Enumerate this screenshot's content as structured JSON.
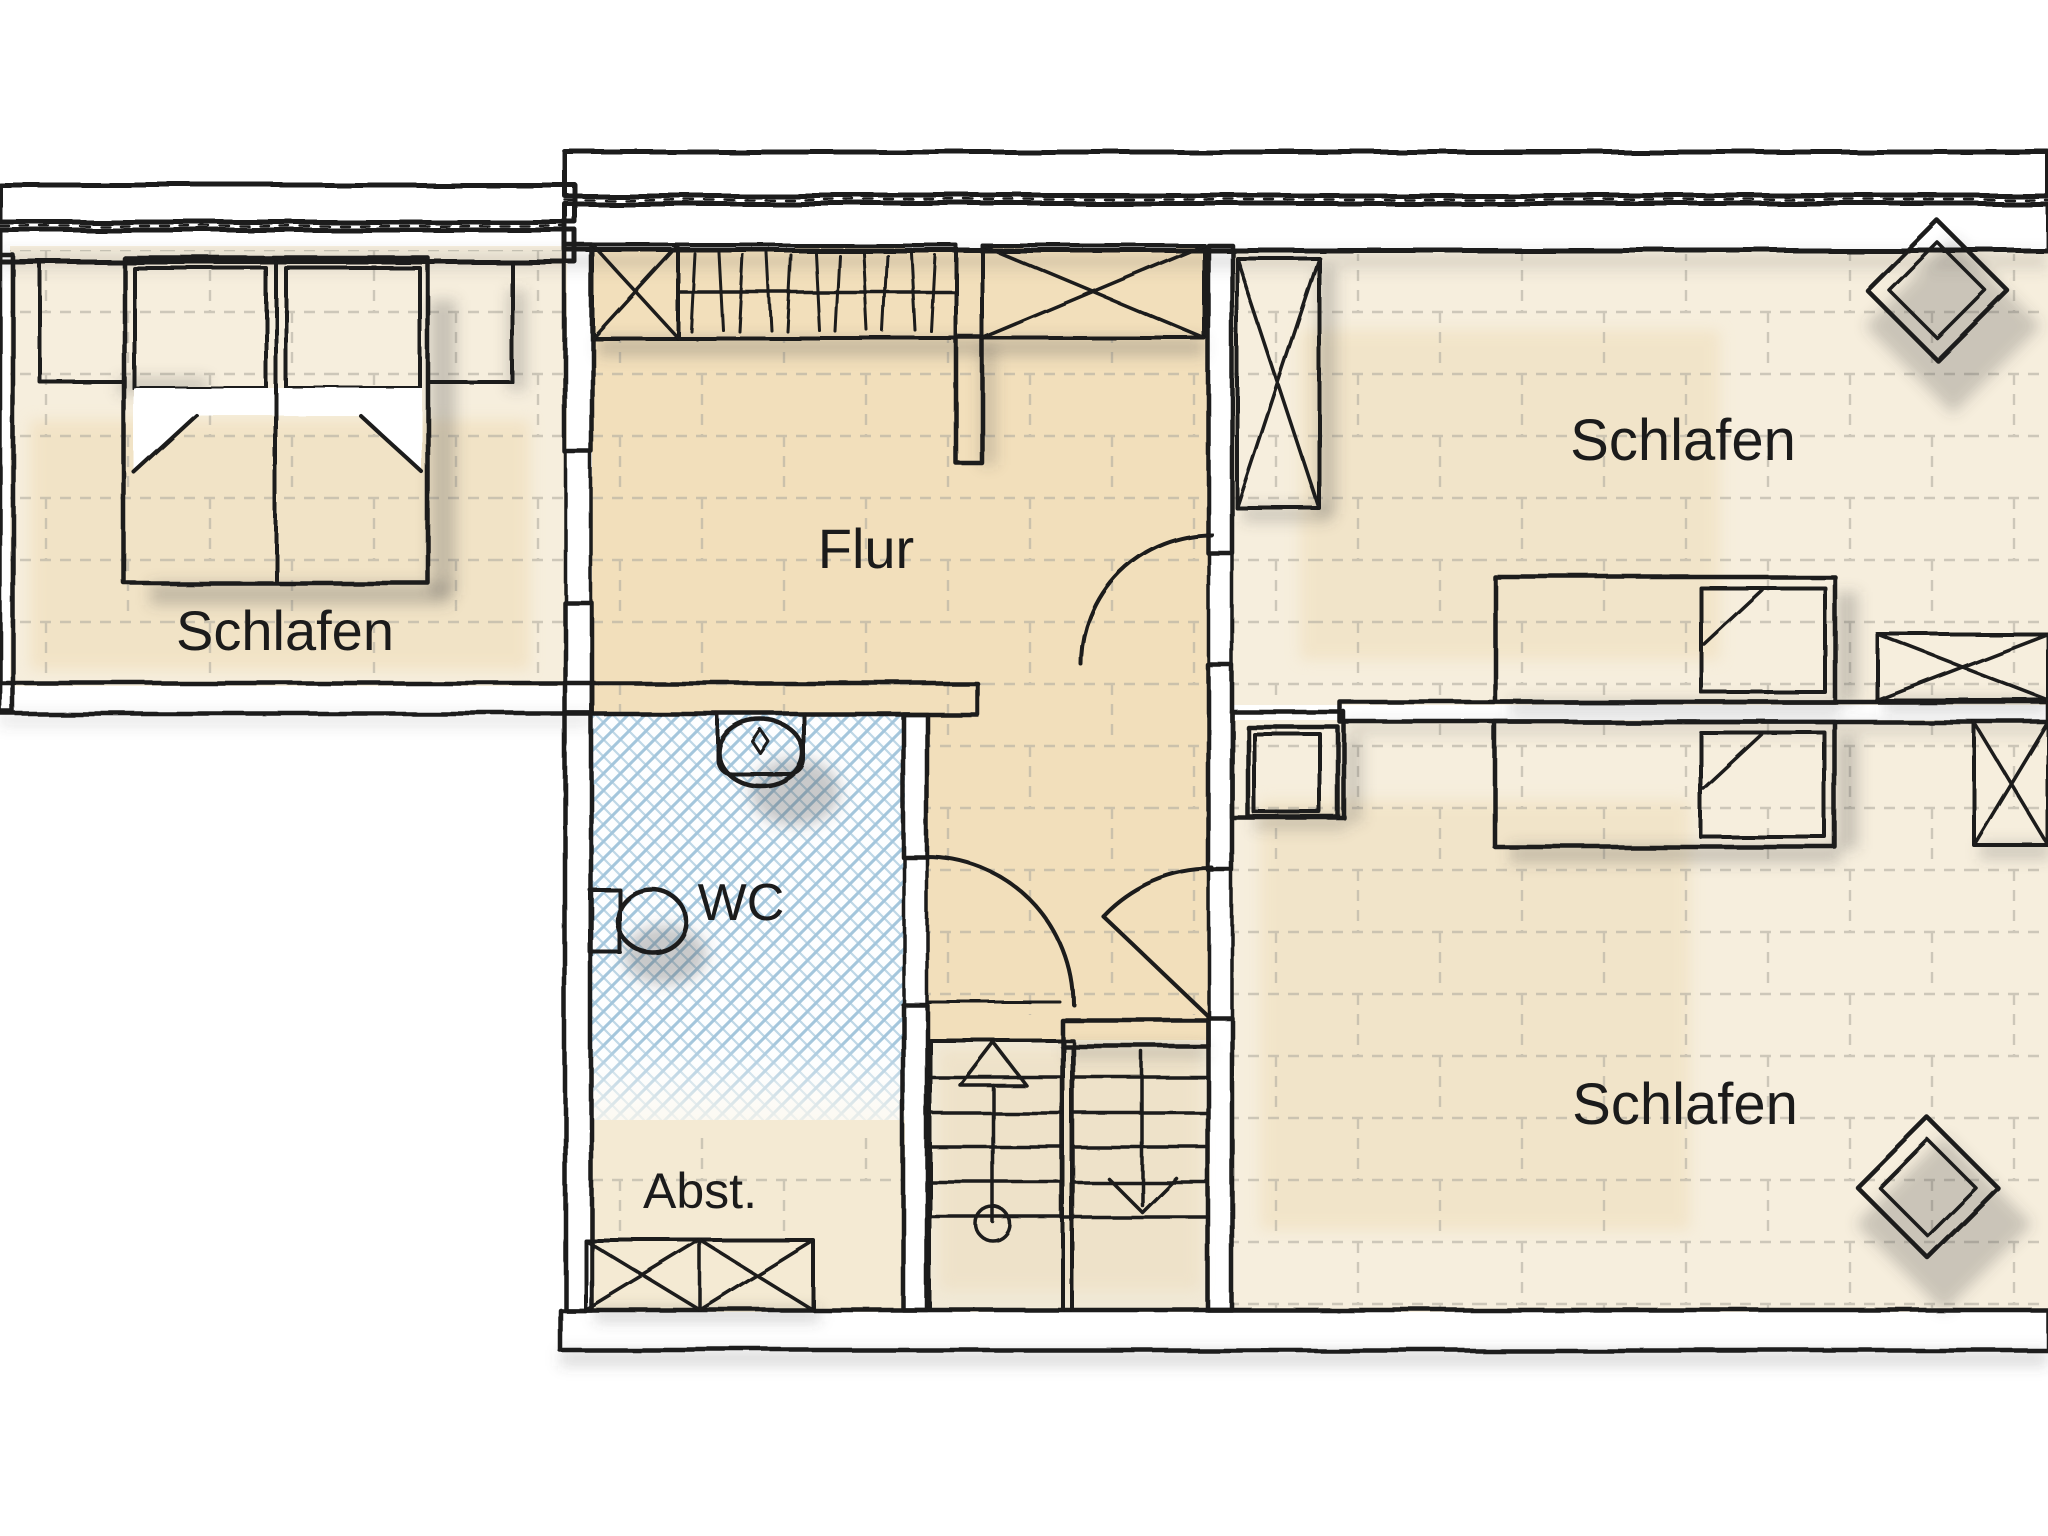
{
  "plan": {
    "kind": "architectural floor plan, hand-drawn colored style",
    "language": "de"
  },
  "rooms": [
    {
      "id": "bedroom-left",
      "label": "Schlafen"
    },
    {
      "id": "hallway",
      "label": "Flur"
    },
    {
      "id": "wc",
      "label": "WC"
    },
    {
      "id": "storage",
      "label": "Abst."
    },
    {
      "id": "bedroom-top-right",
      "label": "Schlafen"
    },
    {
      "id": "bedroom-bottom-right",
      "label": "Schlafen"
    }
  ],
  "furniture": [
    "double-bed-with-nightstands",
    "wardrobe-with-hangers",
    "x-cabinet",
    "single-bed",
    "single-bed",
    "armchair-diamond",
    "armchair-diamond",
    "tall-x-cabinet",
    "sideboard-x-cabinet",
    "storage-x-cabinet",
    "sink",
    "toilet",
    "switchback-staircase",
    "chimney-block"
  ],
  "colors": {
    "ink": "#1a1a1a",
    "label": "#1b1b1b",
    "wall_bg": "#d4d4d4",
    "wall_hatch": "#878787",
    "bed_orange": "#ec9c4e",
    "cabinet_tan": "#bfa06a",
    "tile_blue": "#a4c6dc",
    "floor_warm": "#f2dfbb",
    "floor_pale": "#f6eedd",
    "floor_storage": "#f4ead3"
  }
}
